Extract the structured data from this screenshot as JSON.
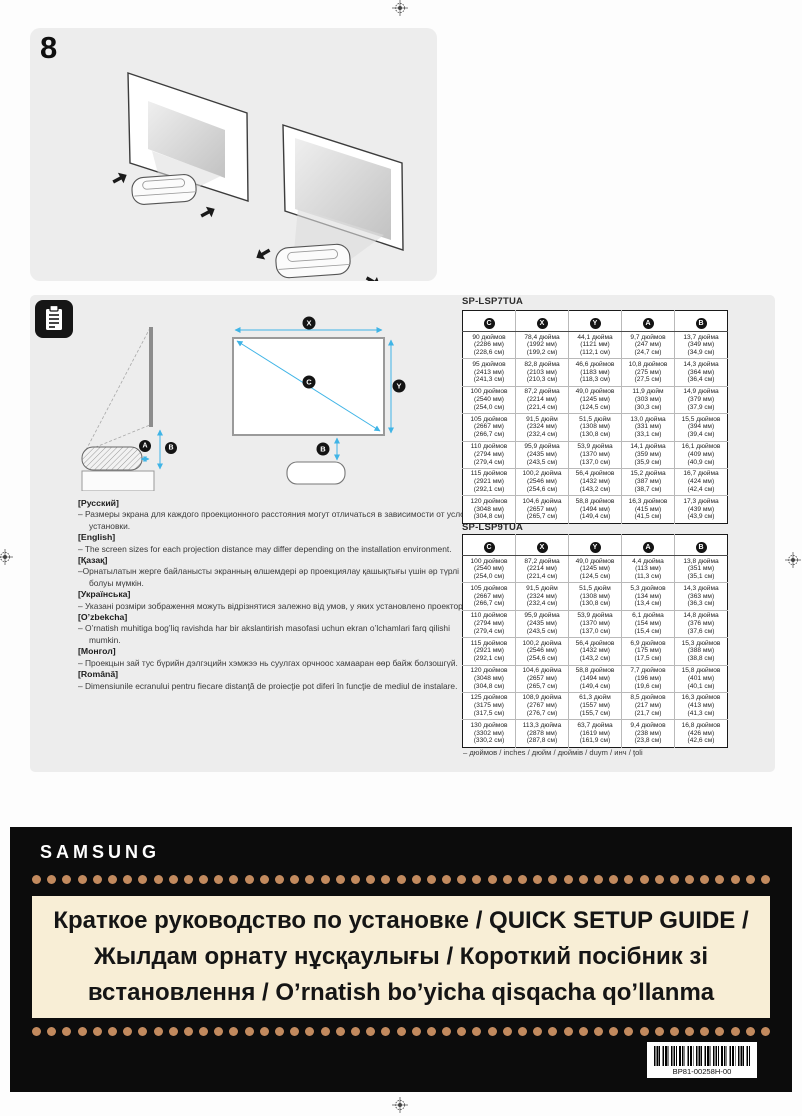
{
  "page": {
    "step_number": "8"
  },
  "colors": {
    "panel_bg": "#ededed",
    "arrow_accent": "#3fb4e6",
    "banner_bg": "#0c0c0c",
    "dot": "#c28a5e",
    "title_box_bg": "#f8eed6"
  },
  "diagram": {
    "badge_a": "A",
    "badge_b": "B",
    "badge_c": "C",
    "badge_x": "X",
    "badge_y": "Y"
  },
  "notes": [
    {
      "lang": "[Русский]",
      "text": "–  Размеры экрана для каждого проекционного расстояния могут отличаться в зависимости от условий установки."
    },
    {
      "lang": "[English]",
      "text": "–  The screen sizes for each projection distance may differ depending on the installation environment."
    },
    {
      "lang": "[Қазақ]",
      "text": "–Орнатылатын жерге байланысты экранның өлшемдері әр проекциялау қашықтығы үшін әр түрлі болуы мүмкін."
    },
    {
      "lang": "[Українська]",
      "text": "–  Указані розміри зображення можуть відрізнятися залежно від умов, у яких установлено проектор."
    },
    {
      "lang": "[O’zbekcha]",
      "text": "–  O’rnatish muhitiga bog’liq ravishda har bir akslantirish masofasi uchun ekran o’lchamlari farq qilishi mumkin."
    },
    {
      "lang": "[Монгол]",
      "text": "–  Проекцын зай тус бүрийн дэлгэцийн хэмжээ нь суулгах орчноос хамааран өөр байж болзошгүй."
    },
    {
      "lang": "[Română]",
      "text": "–  Dimensiunile ecranului pentru fiecare distanţă de proiecţie pot diferi în funcţie de mediul de instalare."
    }
  ],
  "tables": [
    {
      "title": "SP-LSP7TUA",
      "headers": [
        "C",
        "X",
        "Y",
        "A",
        "B"
      ],
      "rows": [
        [
          [
            "90 дюймов",
            "(2286 мм)",
            "(228,6 см)"
          ],
          [
            "78,4 дюйма",
            "(1992 мм)",
            "(199,2 см)"
          ],
          [
            "44,1 дюйма",
            "(1121 мм)",
            "(112,1 см)"
          ],
          [
            "9,7 дюймов",
            "(247 мм)",
            "(24,7 см)"
          ],
          [
            "13,7 дюйма",
            "(349 мм)",
            "(34,9 см)"
          ]
        ],
        [
          [
            "95 дюймов",
            "(2413 мм)",
            "(241,3 см)"
          ],
          [
            "82,8 дюйма",
            "(2103 мм)",
            "(210,3 см)"
          ],
          [
            "46,6 дюймов",
            "(1183 мм)",
            "(118,3 см)"
          ],
          [
            "10,8 дюймов",
            "(275 мм)",
            "(27,5 см)"
          ],
          [
            "14,3 дюйма",
            "(364 мм)",
            "(36,4 см)"
          ]
        ],
        [
          [
            "100 дюймов",
            "(2540 мм)",
            "(254,0 см)"
          ],
          [
            "87,2 дюйма",
            "(2214 мм)",
            "(221,4 см)"
          ],
          [
            "49,0 дюймов",
            "(1245 мм)",
            "(124,5 см)"
          ],
          [
            "11,9 дюйм",
            "(303 мм)",
            "(30,3 см)"
          ],
          [
            "14,9 дюйма",
            "(379 мм)",
            "(37,9 см)"
          ]
        ],
        [
          [
            "105 дюймов",
            "(2667 мм)",
            "(266,7 см)"
          ],
          [
            "91,5 дюйм",
            "(2324 мм)",
            "(232,4 см)"
          ],
          [
            "51,5 дюйм",
            "(1308 мм)",
            "(130,8 см)"
          ],
          [
            "13,0 дюйма",
            "(331 мм)",
            "(33,1 см)"
          ],
          [
            "15,5 дюймов",
            "(394 мм)",
            "(39,4 см)"
          ]
        ],
        [
          [
            "110 дюймов",
            "(2794 мм)",
            "(279,4 см)"
          ],
          [
            "95,9 дюйма",
            "(2435 мм)",
            "(243,5 см)"
          ],
          [
            "53,9 дюйма",
            "(1370 мм)",
            "(137,0 см)"
          ],
          [
            "14,1 дюйма",
            "(359 мм)",
            "(35,9 см)"
          ],
          [
            "16,1 дюймов",
            "(409 мм)",
            "(40,9 см)"
          ]
        ],
        [
          [
            "115 дюймов",
            "(2921 мм)",
            "(292,1 см)"
          ],
          [
            "100,2 дюйма",
            "(2546 мм)",
            "(254,6 см)"
          ],
          [
            "56,4 дюймов",
            "(1432 мм)",
            "(143,2 см)"
          ],
          [
            "15,2 дюйма",
            "(387 мм)",
            "(38,7 см)"
          ],
          [
            "16,7 дюйма",
            "(424 мм)",
            "(42,4 см)"
          ]
        ],
        [
          [
            "120 дюймов",
            "(3048 мм)",
            "(304,8 см)"
          ],
          [
            "104,6 дюйма",
            "(2657 мм)",
            "(265,7 см)"
          ],
          [
            "58,8 дюймов",
            "(1494 мм)",
            "(149,4 см)"
          ],
          [
            "16,3 дюймов",
            "(415 мм)",
            "(41,5 см)"
          ],
          [
            "17,3 дюйма",
            "(439 мм)",
            "(43,9 см)"
          ]
        ]
      ]
    },
    {
      "title": "SP-LSP9TUA",
      "headers": [
        "C",
        "X",
        "Y",
        "A",
        "B"
      ],
      "rows": [
        [
          [
            "100 дюймов",
            "(2540 мм)",
            "(254,0 см)"
          ],
          [
            "87,2 дюйма",
            "(2214 мм)",
            "(221,4 см)"
          ],
          [
            "49,0 дюймов",
            "(1245 мм)",
            "(124,5 см)"
          ],
          [
            "4,4 дюйма",
            "(113 мм)",
            "(11,3 см)"
          ],
          [
            "13,8 дюйма",
            "(351 мм)",
            "(35,1 см)"
          ]
        ],
        [
          [
            "105 дюймов",
            "(2667 мм)",
            "(266,7 см)"
          ],
          [
            "91,5 дюйм",
            "(2324 мм)",
            "(232,4 см)"
          ],
          [
            "51,5 дюйм",
            "(1308 мм)",
            "(130,8 см)"
          ],
          [
            "5,3 дюймов",
            "(134 мм)",
            "(13,4 см)"
          ],
          [
            "14,3 дюйма",
            "(363 мм)",
            "(36,3 см)"
          ]
        ],
        [
          [
            "110 дюймов",
            "(2794 мм)",
            "(279,4 см)"
          ],
          [
            "95,9 дюйма",
            "(2435 мм)",
            "(243,5 см)"
          ],
          [
            "53,9 дюйма",
            "(1370 мм)",
            "(137,0 см)"
          ],
          [
            "6,1 дюйма",
            "(154 мм)",
            "(15,4 см)"
          ],
          [
            "14,8 дюйма",
            "(376 мм)",
            "(37,6 см)"
          ]
        ],
        [
          [
            "115 дюймов",
            "(2921 мм)",
            "(292,1 см)"
          ],
          [
            "100,2 дюйма",
            "(2546 мм)",
            "(254,6 см)"
          ],
          [
            "56,4 дюймов",
            "(1432 мм)",
            "(143,2 см)"
          ],
          [
            "6,9 дюймов",
            "(175 мм)",
            "(17,5 см)"
          ],
          [
            "15,3 дюймов",
            "(388 мм)",
            "(38,8 см)"
          ]
        ],
        [
          [
            "120 дюймов",
            "(3048 мм)",
            "(304,8 см)"
          ],
          [
            "104,6 дюйма",
            "(2657 мм)",
            "(265,7 см)"
          ],
          [
            "58,8 дюймов",
            "(1494 мм)",
            "(149,4 см)"
          ],
          [
            "7,7 дюймов",
            "(196 мм)",
            "(19,6 см)"
          ],
          [
            "15,8 дюймов",
            "(401 мм)",
            "(40,1 см)"
          ]
        ],
        [
          [
            "125 дюймов",
            "(3175 мм)",
            "(317,5 см)"
          ],
          [
            "108,9 дюйма",
            "(2767 мм)",
            "(276,7 см)"
          ],
          [
            "61,3 дюйм",
            "(1557 мм)",
            "(155,7 см)"
          ],
          [
            "8,5 дюймов",
            "(217 мм)",
            "(21,7 см)"
          ],
          [
            "16,3 дюймов",
            "(413 мм)",
            "(41,3 см)"
          ]
        ],
        [
          [
            "130 дюймов",
            "(3302 мм)",
            "(330,2 см)"
          ],
          [
            "113,3 дюйма",
            "(2878 мм)",
            "(287,8 см)"
          ],
          [
            "63,7 дюйма",
            "(1619 мм)",
            "(161,9 см)"
          ],
          [
            "9,4 дюймов",
            "(238 мм)",
            "(23,8 см)"
          ],
          [
            "16,8 дюймов",
            "(426 мм)",
            "(42,6 см)"
          ]
        ]
      ]
    }
  ],
  "tables_footnote": "– дюймов / inches / дюйм / дюймів / duym / инч / ţoli",
  "banner": {
    "logo": "SAMSUNG",
    "title": "Краткое руководство по установке / QUICK SETUP GUIDE / Жылдам орнату нұсқаулығы / Короткий посібник зі встановлення / O’rnatish bo’yicha qisqacha qo’llanma",
    "barcode_text": "BP81-00258H-00"
  }
}
